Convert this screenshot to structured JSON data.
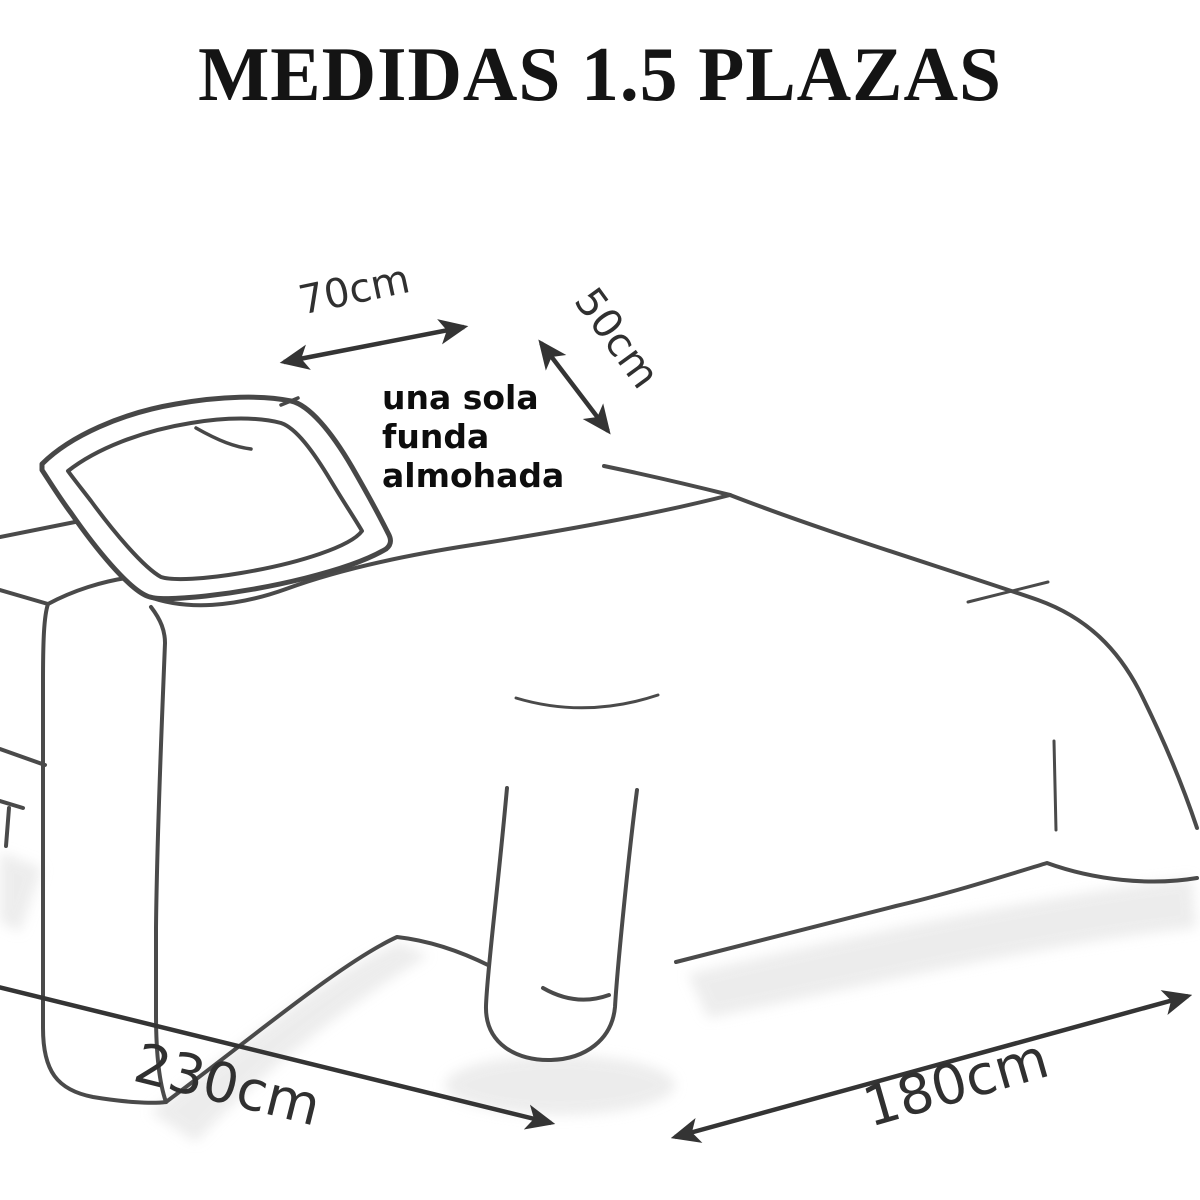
{
  "title": "MEDIDAS 1.5 PLAZAS",
  "annotation": {
    "line1": "una sola",
    "line2": "funda",
    "line3": "almohada"
  },
  "dimensions": {
    "pillow_width": {
      "label": "70cm",
      "target": "pillow width"
    },
    "pillow_depth": {
      "label": "50cm",
      "target": "pillow depth"
    },
    "bed_length": {
      "label": "230cm",
      "target": "bed length"
    },
    "bed_width": {
      "label": "180cm",
      "target": "bed width"
    }
  },
  "colors": {
    "background": "#ffffff",
    "ink": "#4a4a4a",
    "title_text": "#141414",
    "dimension_text": "#303030",
    "annotation_text": "#0d0d0d",
    "shadow": "#e2e2e2"
  }
}
